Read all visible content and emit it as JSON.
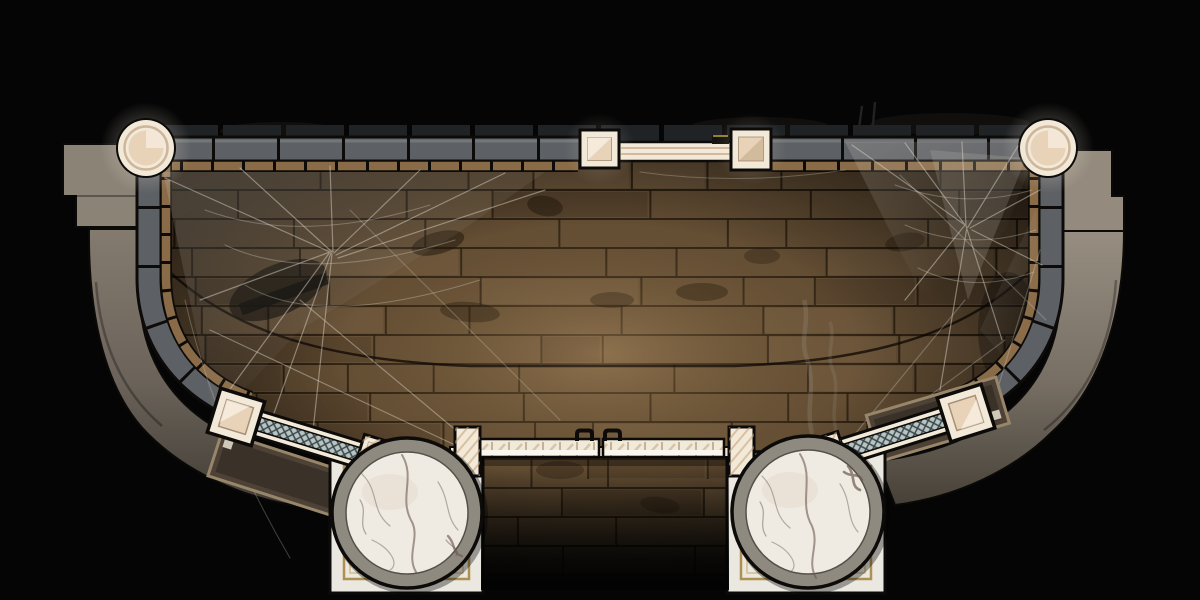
{
  "meta": {
    "type": "top-down-battle-map",
    "theme": "abandoned marble-pillared hall with cobwebs",
    "width": 1200,
    "height": 600,
    "visible_text": "none"
  },
  "palette": {
    "bg": "#050505",
    "floor_base": "#5e4a32",
    "floor_light": "#8a6c46",
    "grout": "#150e07",
    "wall_gray": "#5d6064",
    "wall_dark": "#2b2d30",
    "trim_tan": "#8a6b47",
    "terrace_light": "#8e8579",
    "terrace_mid": "#6e665c",
    "terrace_dark": "#3c3730",
    "cream": "#f2e9d8",
    "cream_inner": "#e8d3b9",
    "beam_white": "#f2ead9",
    "bright_white": "#fbf7ee",
    "lattice_bg": "#b9c4c1",
    "lattice_line": "#37464b",
    "marble": "#efeae2",
    "marble_vein": "#6b5a50",
    "pillar_ring": "#8f8a80",
    "wood_platform": "#4e4236",
    "platform_edge": "#98866a",
    "gold_trim": "#ad9150",
    "gold_trim_light": "#d3bd85",
    "web": "#ded8cc",
    "smoke": "#c8c8c4",
    "stain": "#1d1309"
  },
  "floor": {
    "seed": 11,
    "row_h": 29,
    "grout_color": "#140d06",
    "regions": [
      {
        "x": 151,
        "y": 160,
        "w": 898,
        "h": 300
      },
      {
        "x": 484,
        "y": 458,
        "w": 242,
        "h": 122
      }
    ]
  },
  "stains": [
    {
      "x": 438,
      "y": 243,
      "rx": 27,
      "ry": 11,
      "rot": -15,
      "o": 0.5
    },
    {
      "x": 545,
      "y": 206,
      "rx": 18,
      "ry": 10,
      "rot": 10,
      "o": 0.45
    },
    {
      "x": 470,
      "y": 312,
      "rx": 30,
      "ry": 10,
      "rot": 5,
      "o": 0.35
    },
    {
      "x": 612,
      "y": 300,
      "rx": 22,
      "ry": 8,
      "rot": 0,
      "o": 0.3
    },
    {
      "x": 702,
      "y": 292,
      "rx": 26,
      "ry": 9,
      "rot": 0,
      "o": 0.35
    },
    {
      "x": 762,
      "y": 256,
      "rx": 18,
      "ry": 8,
      "rot": 0,
      "o": 0.3
    },
    {
      "x": 1086,
      "y": 268,
      "rx": 30,
      "ry": 15,
      "rot": 20,
      "o": 0.5
    },
    {
      "x": 905,
      "y": 242,
      "rx": 20,
      "ry": 9,
      "rot": -10,
      "o": 0.35
    },
    {
      "x": 560,
      "y": 470,
      "rx": 24,
      "ry": 9,
      "rot": 0,
      "o": 0.3
    },
    {
      "x": 660,
      "y": 505,
      "rx": 20,
      "ry": 8,
      "rot": 8,
      "o": 0.3
    }
  ],
  "features": {
    "corner_towers": 2,
    "north_gate_posts": 2,
    "marble_pillars": 2,
    "railed_walkways": 2,
    "cobweb_clusters": 3,
    "bench_handles": 2
  }
}
